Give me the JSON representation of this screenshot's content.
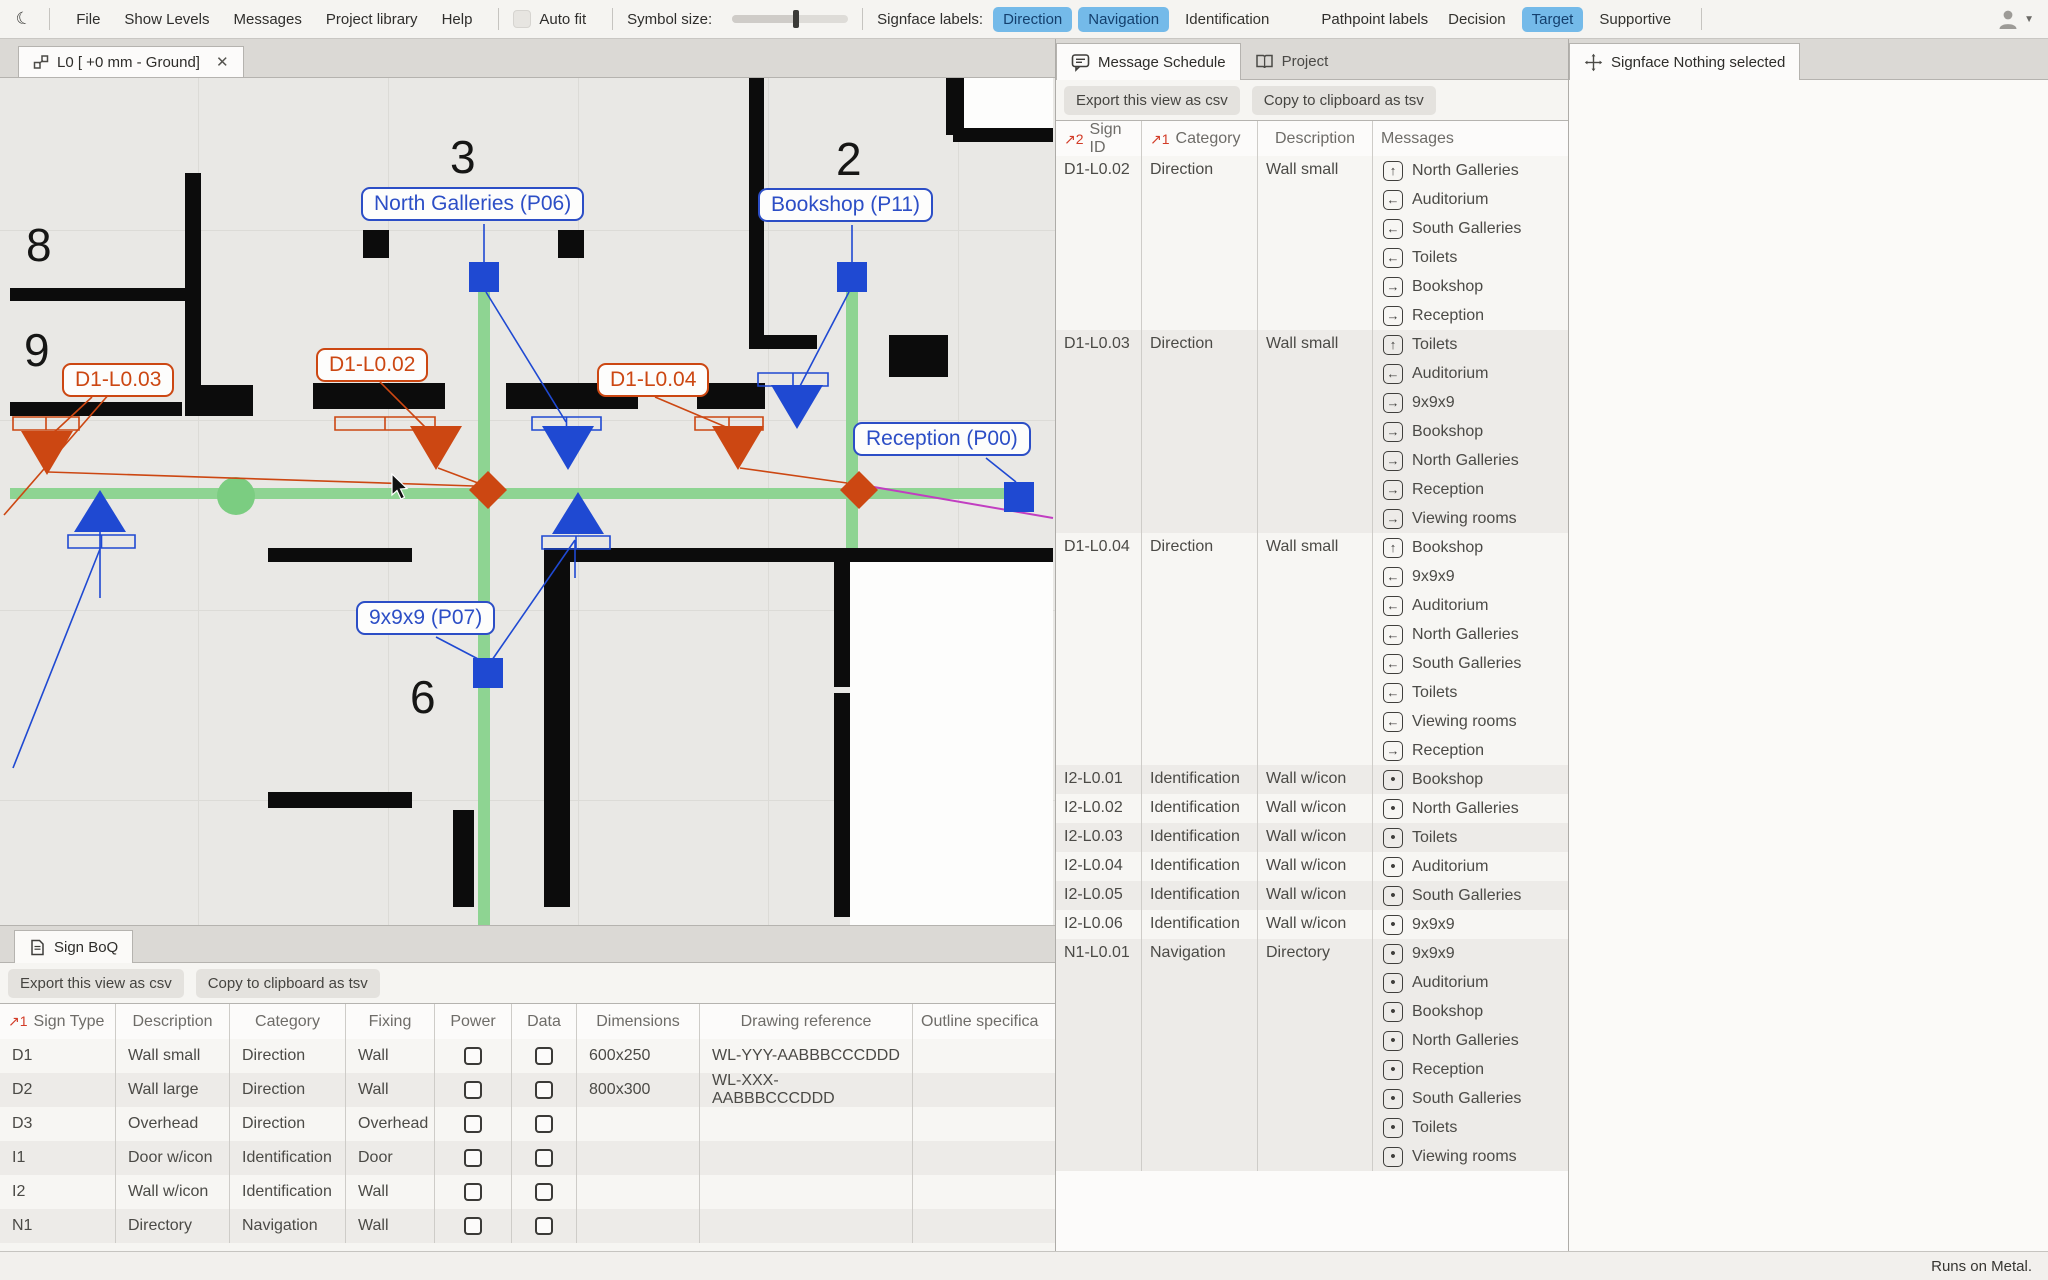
{
  "topbar": {
    "menus": [
      "File",
      "Show Levels",
      "Messages",
      "Project library",
      "Help"
    ],
    "auto_fit": {
      "label": "Auto fit",
      "checked": false
    },
    "symbol_size": {
      "label": "Symbol size:",
      "value_pct": 55
    },
    "signface_labels": {
      "label": "Signface labels:",
      "options": [
        {
          "label": "Direction",
          "active": true
        },
        {
          "label": "Navigation",
          "active": true
        },
        {
          "label": "Identification",
          "active": false
        }
      ]
    },
    "pathpoint_labels": {
      "label": "Pathpoint labels",
      "options": [
        {
          "label": "Decision",
          "active": false
        },
        {
          "label": "Target",
          "active": true
        },
        {
          "label": "Supportive",
          "active": false
        }
      ]
    }
  },
  "canvas": {
    "tab_title": "L0 [ +0 mm - Ground]",
    "room_numbers": [
      "8",
      "9",
      "3",
      "2",
      "6"
    ],
    "pathpoint_labels": [
      {
        "id": "P06",
        "text": "North Galleries (P06)"
      },
      {
        "id": "P11",
        "text": "Bookshop (P11)"
      },
      {
        "id": "P00",
        "text": "Reception (P00)"
      },
      {
        "id": "P07",
        "text": "9x9x9 (P07)"
      }
    ],
    "signface_flags": [
      {
        "id": "D1-L0.03",
        "text": "D1-L0.03"
      },
      {
        "id": "D1-L0.02",
        "text": "D1-L0.02"
      },
      {
        "id": "D1-L0.04",
        "text": "D1-L0.04"
      }
    ]
  },
  "message_panel": {
    "tabs": [
      {
        "label": "Message Schedule",
        "icon": "speech-bubble",
        "active": true
      },
      {
        "label": "Project",
        "icon": "book",
        "active": false
      }
    ],
    "buttons": [
      "Export this view as csv",
      "Copy to clipboard as tsv"
    ],
    "columns": [
      {
        "label": "Sign ID",
        "sort": "2"
      },
      {
        "label": "Category",
        "sort": "1"
      },
      {
        "label": "Description",
        "sort": ""
      },
      {
        "label": "Messages",
        "sort": ""
      }
    ],
    "rows": [
      {
        "sign_id": "D1-L0.02",
        "category": "Direction",
        "description": "Wall small",
        "messages": [
          {
            "arrow": "up",
            "text": "North Galleries"
          },
          {
            "arrow": "left",
            "text": "Auditorium"
          },
          {
            "arrow": "left",
            "text": "South Galleries"
          },
          {
            "arrow": "left",
            "text": "Toilets"
          },
          {
            "arrow": "right",
            "text": "Bookshop"
          },
          {
            "arrow": "right",
            "text": "Reception"
          }
        ]
      },
      {
        "sign_id": "D1-L0.03",
        "category": "Direction",
        "description": "Wall small",
        "messages": [
          {
            "arrow": "up",
            "text": "Toilets"
          },
          {
            "arrow": "left",
            "text": "Auditorium"
          },
          {
            "arrow": "right",
            "text": "9x9x9"
          },
          {
            "arrow": "right",
            "text": "Bookshop"
          },
          {
            "arrow": "right",
            "text": "North Galleries"
          },
          {
            "arrow": "right",
            "text": "Reception"
          },
          {
            "arrow": "right",
            "text": "Viewing rooms"
          }
        ]
      },
      {
        "sign_id": "D1-L0.04",
        "category": "Direction",
        "description": "Wall small",
        "messages": [
          {
            "arrow": "up",
            "text": "Bookshop"
          },
          {
            "arrow": "left",
            "text": "9x9x9"
          },
          {
            "arrow": "left",
            "text": "Auditorium"
          },
          {
            "arrow": "left",
            "text": "North Galleries"
          },
          {
            "arrow": "left",
            "text": "South Galleries"
          },
          {
            "arrow": "left",
            "text": "Toilets"
          },
          {
            "arrow": "left",
            "text": "Viewing rooms"
          },
          {
            "arrow": "right",
            "text": "Reception"
          }
        ]
      },
      {
        "sign_id": "I2-L0.01",
        "category": "Identification",
        "description": "Wall w/icon",
        "messages": [
          {
            "arrow": "dot",
            "text": "Bookshop"
          }
        ]
      },
      {
        "sign_id": "I2-L0.02",
        "category": "Identification",
        "description": "Wall w/icon",
        "messages": [
          {
            "arrow": "dot",
            "text": "North Galleries"
          }
        ]
      },
      {
        "sign_id": "I2-L0.03",
        "category": "Identification",
        "description": "Wall w/icon",
        "messages": [
          {
            "arrow": "dot",
            "text": "Toilets"
          }
        ]
      },
      {
        "sign_id": "I2-L0.04",
        "category": "Identification",
        "description": "Wall w/icon",
        "messages": [
          {
            "arrow": "dot",
            "text": "Auditorium"
          }
        ]
      },
      {
        "sign_id": "I2-L0.05",
        "category": "Identification",
        "description": "Wall w/icon",
        "messages": [
          {
            "arrow": "dot",
            "text": "South Galleries"
          }
        ]
      },
      {
        "sign_id": "I2-L0.06",
        "category": "Identification",
        "description": "Wall w/icon",
        "messages": [
          {
            "arrow": "dot",
            "text": "9x9x9"
          }
        ]
      },
      {
        "sign_id": "N1-L0.01",
        "category": "Navigation",
        "description": "Directory",
        "messages": [
          {
            "arrow": "dot",
            "text": "9x9x9"
          },
          {
            "arrow": "dot",
            "text": "Auditorium"
          },
          {
            "arrow": "dot",
            "text": "Bookshop"
          },
          {
            "arrow": "dot",
            "text": "North Galleries"
          },
          {
            "arrow": "dot",
            "text": "Reception"
          },
          {
            "arrow": "dot",
            "text": "South Galleries"
          },
          {
            "arrow": "dot",
            "text": "Toilets"
          },
          {
            "arrow": "dot",
            "text": "Viewing rooms"
          }
        ]
      }
    ]
  },
  "signface_panel": {
    "tab_label": "Signface Nothing selected"
  },
  "boq_panel": {
    "tab_label": "Sign BoQ",
    "buttons": [
      "Export this view as csv",
      "Copy to clipboard as tsv"
    ],
    "columns": [
      {
        "label": "Sign Type",
        "sort": "1"
      },
      {
        "label": "Description",
        "sort": ""
      },
      {
        "label": "Category",
        "sort": ""
      },
      {
        "label": "Fixing",
        "sort": ""
      },
      {
        "label": "Power",
        "sort": ""
      },
      {
        "label": "Data",
        "sort": ""
      },
      {
        "label": "Dimensions",
        "sort": ""
      },
      {
        "label": "Drawing reference",
        "sort": ""
      },
      {
        "label": "Outline specifica",
        "sort": ""
      }
    ],
    "rows": [
      {
        "sign_type": "D1",
        "description": "Wall small",
        "category": "Direction",
        "fixing": "Wall",
        "power": false,
        "data": false,
        "dimensions": "600x250",
        "drawing_reference": "WL-YYY-AABBBCCCDDD",
        "outline": ""
      },
      {
        "sign_type": "D2",
        "description": "Wall large",
        "category": "Direction",
        "fixing": "Wall",
        "power": false,
        "data": false,
        "dimensions": "800x300",
        "drawing_reference": "WL-XXX-AABBBCCCDDD",
        "outline": ""
      },
      {
        "sign_type": "D3",
        "description": "Overhead",
        "category": "Direction",
        "fixing": "Overhead",
        "power": false,
        "data": false,
        "dimensions": "",
        "drawing_reference": "",
        "outline": ""
      },
      {
        "sign_type": "I1",
        "description": "Door w/icon",
        "category": "Identification",
        "fixing": "Door",
        "power": false,
        "data": false,
        "dimensions": "",
        "drawing_reference": "",
        "outline": ""
      },
      {
        "sign_type": "I2",
        "description": "Wall w/icon",
        "category": "Identification",
        "fixing": "Wall",
        "power": false,
        "data": false,
        "dimensions": "",
        "drawing_reference": "",
        "outline": ""
      },
      {
        "sign_type": "N1",
        "description": "Directory",
        "category": "Navigation",
        "fixing": "Wall",
        "power": false,
        "data": false,
        "dimensions": "",
        "drawing_reference": "",
        "outline": ""
      }
    ]
  },
  "statusbar": {
    "text": "Runs on Metal."
  },
  "colors": {
    "accent_blue": "#2c4ec6",
    "symbol_blue": "#1f49d2",
    "accent_orange": "#cc4712",
    "path_green": "#8ed492",
    "toggle_blue": "#74bae9",
    "sort_red": "#d23b27",
    "magenta": "#c13ec1"
  }
}
